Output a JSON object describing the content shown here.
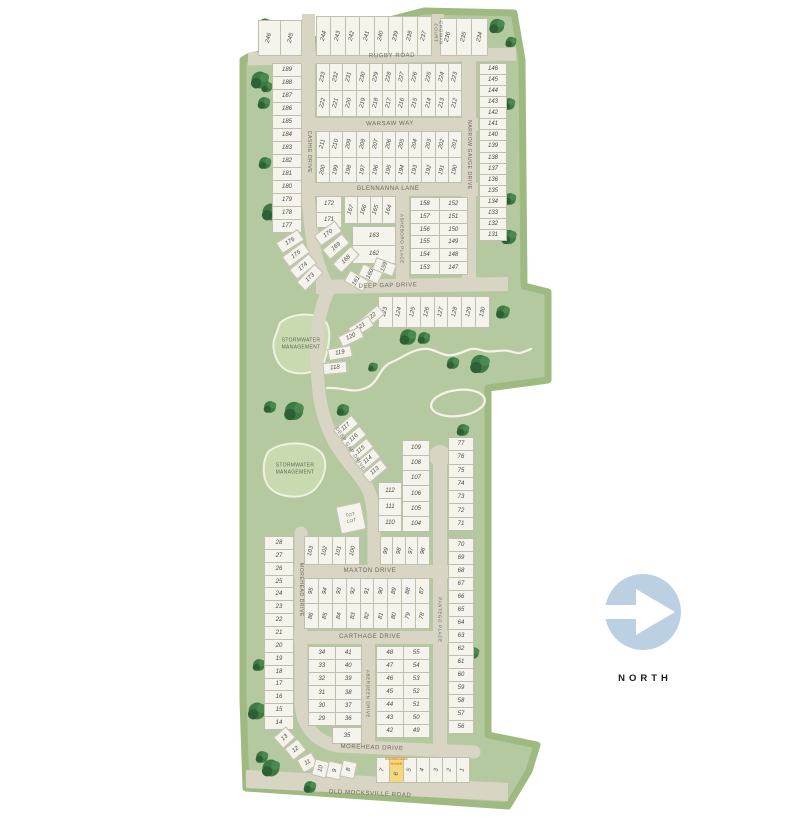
{
  "north": {
    "label": "NORTH"
  },
  "labels": {
    "stormwater": "STORMWATER MANAGEMENT",
    "tot_lot": "TOT LOT",
    "showcase": "SHOWCASE HOME"
  },
  "streets": {
    "rugby": "RUGBY ROAD",
    "chowan": "CHOWAN COURT",
    "warsaw": "WARSAW WAY",
    "cashie": "CASHIE DRIVE",
    "narrow_gauge": "NARROW GAUGE DRIVE",
    "glennanna": "GLENNANNA LANE",
    "asheboro": "ASHEBORO PLACE",
    "deep_gap": "DEEP GAP DRIVE",
    "maxton": "MAXTON DRIVE",
    "morehead": "MOREHEAD DRIVE",
    "carthage": "CARTHAGE DRIVE",
    "aberdeen": "ABERDEEN DRIVE",
    "pantego": "PANTEGO PLACE",
    "old_mocksville": "OLD MOCKSVILLE ROAD"
  },
  "blocks": [
    {
      "id": "top_left",
      "lots": [
        "246",
        "245"
      ]
    },
    {
      "id": "top_mid",
      "lots": [
        "244",
        "243",
        "242",
        "241",
        "240",
        "239",
        "238",
        "237"
      ]
    },
    {
      "id": "top_right",
      "lots": [
        "236",
        "235",
        "234"
      ]
    },
    {
      "id": "cashie_west",
      "lots": [
        "189",
        "188",
        "187",
        "186",
        "185",
        "184",
        "183",
        "182",
        "181",
        "180",
        "179",
        "178",
        "177"
      ]
    },
    {
      "id": "rugby_south",
      "lots": [
        "233",
        "232",
        "231",
        "230",
        "229",
        "228",
        "227",
        "226",
        "225",
        "224",
        "223",
        "222",
        "221",
        "220",
        "219",
        "218",
        "217",
        "216",
        "215",
        "214",
        "213",
        "212"
      ]
    },
    {
      "id": "warsaw_south",
      "lots": [
        "211",
        "210",
        "209",
        "208",
        "207",
        "206",
        "205",
        "204",
        "203",
        "202",
        "201",
        "200",
        "199",
        "198",
        "197",
        "196",
        "195",
        "194",
        "193",
        "192",
        "191",
        "190"
      ]
    },
    {
      "id": "narrow_gauge_east",
      "lots": [
        "146",
        "145",
        "144",
        "143",
        "142",
        "141",
        "140",
        "139",
        "138",
        "137",
        "136",
        "135",
        "134",
        "133",
        "132",
        "131"
      ]
    },
    {
      "id": "glennanna_a",
      "lots": [
        "172",
        "171"
      ]
    },
    {
      "id": "glennanna_b",
      "lots": [
        "167",
        "166",
        "165",
        "164"
      ]
    },
    {
      "id": "glennanna_c",
      "lots": [
        "163",
        "162"
      ]
    },
    {
      "id": "asheboro_east",
      "lots": [
        "158",
        "152",
        "157",
        "151",
        "156",
        "150",
        "155",
        "149",
        "154",
        "148",
        "153",
        "147"
      ]
    },
    {
      "id": "deepgap_row",
      "lots": [
        "123",
        "124",
        "125",
        "126",
        "127",
        "128",
        "129",
        "130"
      ]
    },
    {
      "id": "deepgap_col",
      "lots": [
        "109",
        "108",
        "107",
        "106",
        "105",
        "104"
      ]
    },
    {
      "id": "totlot_col",
      "lots": [
        "112",
        "111",
        "110"
      ]
    },
    {
      "id": "pantego_west_upper",
      "lots": [
        "77",
        "76",
        "75",
        "74",
        "73",
        "72",
        "71"
      ]
    },
    {
      "id": "pantego_east",
      "lots": [
        "70",
        "69",
        "68",
        "67",
        "66",
        "65",
        "64",
        "63",
        "62",
        "61",
        "60",
        "59",
        "58",
        "57",
        "56"
      ]
    },
    {
      "id": "maxton_nw",
      "lots": [
        "103",
        "102",
        "101",
        "100"
      ]
    },
    {
      "id": "maxton_ne",
      "lots": [
        "99",
        "98",
        "97",
        "96"
      ]
    },
    {
      "id": "maxton_south",
      "lots": [
        "95",
        "94",
        "93",
        "92",
        "91",
        "90",
        "89",
        "88",
        "87",
        "86",
        "85",
        "84",
        "83",
        "82",
        "81",
        "80",
        "79",
        "78"
      ]
    },
    {
      "id": "morehead_west",
      "lots": [
        "28",
        "27",
        "26",
        "25",
        "24",
        "23",
        "22",
        "21",
        "20",
        "19",
        "18",
        "17",
        "16",
        "15",
        "14"
      ]
    },
    {
      "id": "carthage_sw",
      "lots": [
        "34",
        "41",
        "33",
        "40",
        "32",
        "39",
        "31",
        "38",
        "30",
        "37",
        "29",
        "36"
      ]
    },
    {
      "id": "lot35",
      "lots": [
        "35"
      ]
    },
    {
      "id": "carthage_se",
      "lots": [
        "48",
        "55",
        "47",
        "54",
        "46",
        "53",
        "45",
        "52",
        "44",
        "51",
        "43",
        "50",
        "42",
        "49"
      ]
    },
    {
      "id": "bottom_row",
      "lots": [
        "7",
        "6",
        "5",
        "4",
        "3",
        "2",
        "1"
      ],
      "highlight": "6"
    }
  ],
  "fans": [
    {
      "id": "left_curve",
      "lots": [
        "176",
        "175",
        "174",
        "173"
      ]
    },
    {
      "id": "glennanna_curve",
      "lots": [
        "170",
        "169",
        "168"
      ]
    },
    {
      "id": "deepgap_west",
      "lots": [
        "161",
        "160",
        "159"
      ]
    },
    {
      "id": "deepgap_curve",
      "lots": [
        "122",
        "121",
        "120",
        "119",
        "118"
      ]
    },
    {
      "id": "deepgap_lower",
      "lots": [
        "117",
        "116",
        "115",
        "114",
        "113"
      ]
    },
    {
      "id": "morehead_curve",
      "lots": [
        "13",
        "12",
        "11",
        "10",
        "9",
        "8"
      ]
    }
  ],
  "colors": {
    "site_green": "#b5c9a0",
    "site_green_edge": "#9fba81",
    "road": "#d9d5c5",
    "lot_fill": "#f4f3ec",
    "lot_line": "#c2bead",
    "lot_text": "#4b4a45",
    "street_text": "#6b675a",
    "stormwater_fill": "#c9d9b0",
    "north_circle": "#bcd0e3",
    "showcase_lot": "#f5d97e",
    "showcase_text": "#e2892b",
    "creek": "#f6f3e6"
  }
}
